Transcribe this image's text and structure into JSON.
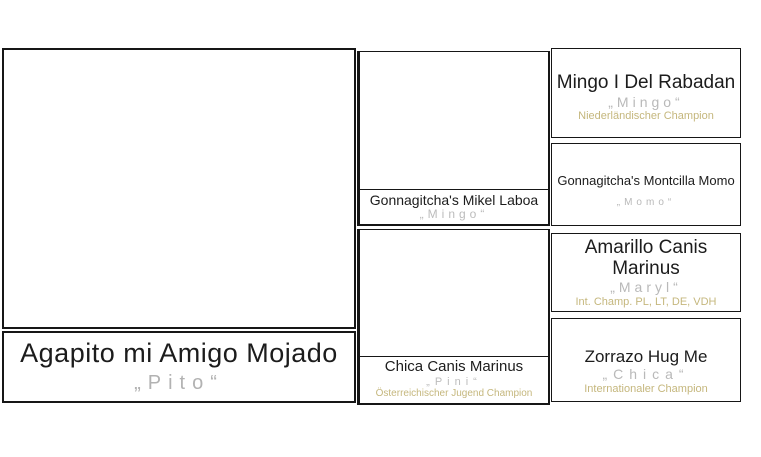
{
  "pedigree": {
    "subject": {
      "name": "Agapito mi Amigo Mojado",
      "call_name": "„Pito“"
    },
    "parents": [
      {
        "name": "Gonnagitcha's Mikel Laboa",
        "call_name": "„Mingo“",
        "title": ""
      },
      {
        "name": "Chica Canis Marinus",
        "call_name": "„Pini“",
        "title": "Österreichischer Jugend Champion"
      }
    ],
    "grandparents": [
      {
        "name": "Mingo I Del Rabadan",
        "call_name": "„Mingo“",
        "title": "Niederländischer Champion"
      },
      {
        "name": "Gonnagitcha's Montcilla Momo",
        "call_name": "„Momo“",
        "title": ""
      },
      {
        "name": "Amarillo Canis Marinus",
        "call_name": "„Maryl“",
        "title": "Int. Champ. PL, LT, DE, VDH"
      },
      {
        "name": "Zorrazo Hug Me",
        "call_name": "„Chica“",
        "title": "Internationaler Champion"
      }
    ],
    "colors": {
      "border": "#161616",
      "name_text": "#1c1c1c",
      "call_name_text": "#b2b2b2",
      "champion_title_text": "#c5b77d"
    }
  }
}
